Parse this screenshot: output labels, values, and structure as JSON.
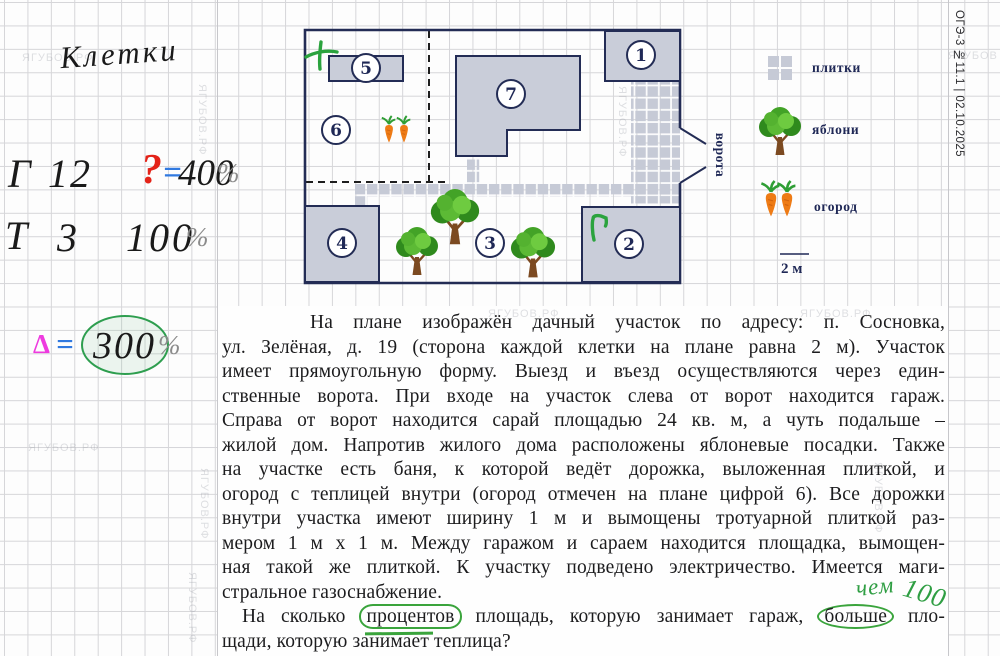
{
  "sheet": {
    "side_label": "ОГЭ-3 №11.1 | 02.10.2025",
    "watermark": "ЯГУБОВ.РФ"
  },
  "notes": {
    "title": "Клетки",
    "row_garage": {
      "letter": "Г",
      "cells": "12",
      "question": "?",
      "equals": "=",
      "value": "400",
      "percent": "%"
    },
    "row_greenhouse": {
      "letter": "Т",
      "cells": "3",
      "value": "100",
      "percent": "%"
    },
    "row_delta": {
      "delta": "Δ",
      "equals": "=",
      "value": "300",
      "percent": "%"
    },
    "answer_hint": {
      "word": "чем",
      "number": "100"
    }
  },
  "plan": {
    "region_numbers": [
      "1",
      "2",
      "3",
      "4",
      "5",
      "6",
      "7"
    ],
    "gate_label": "ворота",
    "legend_tiles": "плитки",
    "legend_apples": "яблони",
    "legend_garden": "огород",
    "scale_label": "2 м",
    "colors": {
      "outline": "#232c55",
      "building_fill": "#c9cdd9",
      "tile_fill": "#c6cad6",
      "annotation_green": "#2ba33e"
    }
  },
  "problem": {
    "lines": [
      "На плане изображён дачный участок по адресу: п. Сосновка,",
      "ул. Зелёная, д. 19 (сторона каждой клетки на плане равна 2 м). Участок",
      "имеет прямоугольную форму. Выезд и въезд осуществляются через един-",
      "ственные ворота. При входе на участок слева от ворот находится гараж.",
      "Справа от ворот находится сарай площадью 24 кв. м, а чуть подальше –",
      "жилой дом. Напротив жилого дома расположены яблоневые посадки. Также",
      "на участке есть баня, к которой ведёт дорожка, выложенная плиткой, и",
      "огород с теплицей внутри (огород отмечен на плане цифрой 6). Все дорожки",
      "внутри участка имеют ширину 1 м и вымощены тротуарной плиткой раз-",
      "мером 1 м х 1 м. Между гаражом и сараем находится площадка, вымощен-",
      "ная такой же плиткой. К участку подведено электричество. Имеется маги-",
      "стральное газоснабжение."
    ],
    "question": {
      "pre": "На сколько",
      "circled_1": "процентов",
      "mid": "площадь, которую занимает гараж,",
      "circled_2": "больше",
      "tail": "пло-"
    },
    "last_line": "щади, которую занимает теплица?"
  }
}
